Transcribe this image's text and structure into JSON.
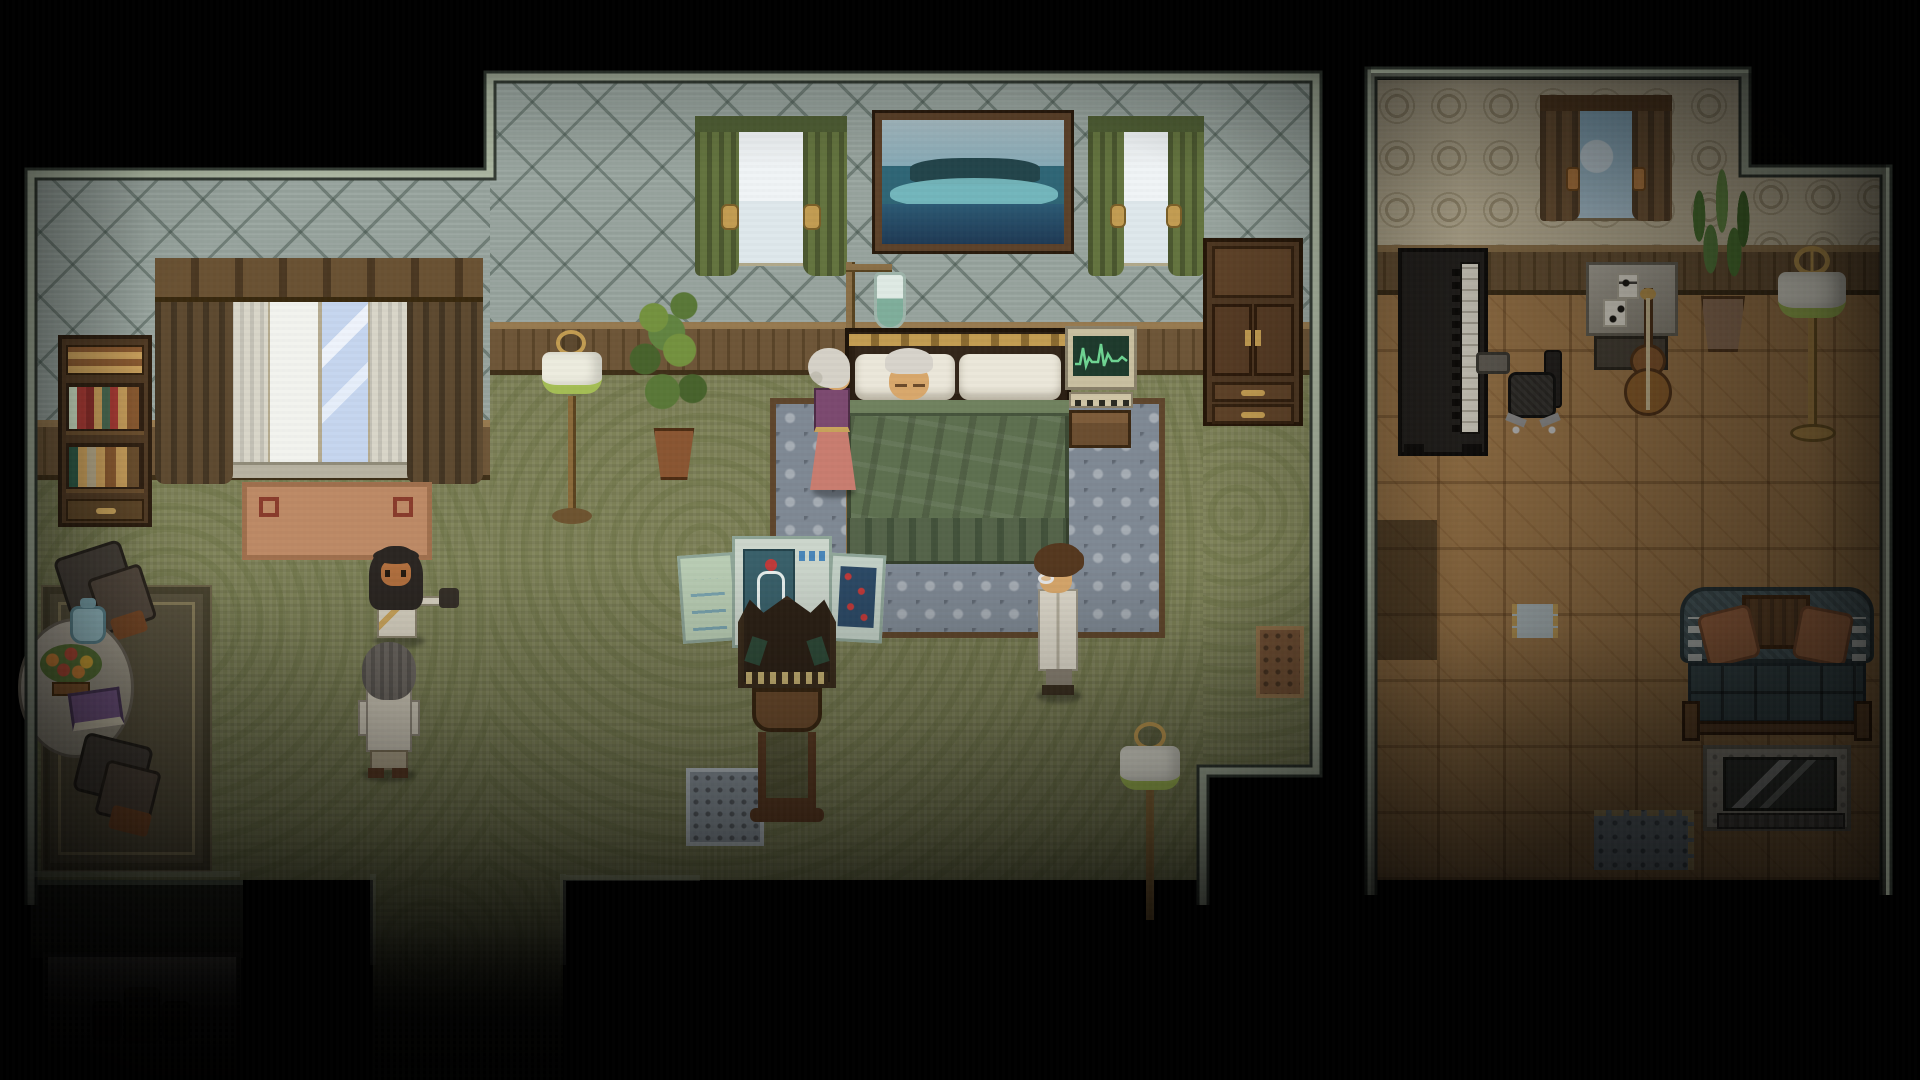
{
  "scene": {
    "viewport_label": "Pixel-art RPG interior — bedroom with patient and adjacent study",
    "visible_text": "",
    "rooms": {
      "bedroom": {
        "label": "Bedroom with sick bed, medical equipment and sitting corner"
      },
      "study": {
        "label": "Study and music room with piano, cello and couch"
      }
    }
  },
  "palette": {
    "bg": "#000000",
    "wall_border": "#aab5a0",
    "wall_border_dark": "#343c34",
    "wallpaper_main": "#95a19b",
    "wainscot": "#6e5638",
    "wainscot_light": "#977a50",
    "carpet": "#7d8157",
    "wood_floor": "#a8804f",
    "wallpaper_study": "#cdc2a4",
    "curtain_green": "#64743f",
    "drape_brown": "#5e4a30",
    "blanket_green": "#5e7050",
    "bed_rug": "#7f8994",
    "rug_border": "#5f462c",
    "monitor_screen": "#1e3a2c",
    "monitor_wave": "#6ed492",
    "lamp_shade": "#edecdf",
    "lamp_rim": "#a4bd55",
    "brass": "#c29c52",
    "skin": "#d9a86c",
    "coat_white": "#ddd8ca",
    "couch_teal": "#54686e",
    "pillow_orange": "#ad6f48",
    "mat_brown": "#7a5638",
    "teapot_blue": "#9cc4cc",
    "book_purple": "#7a5a8c"
  },
  "objects": {
    "bed": {
      "label": "Bed with elderly patient under green blanket"
    },
    "bed_rug": {
      "label": "Patterned blue-gray rug under bed"
    },
    "painting": {
      "label": "Framed seascape painting of an island"
    },
    "window_drapes": {
      "label": "Large window with brown drapes and sheers"
    },
    "window_green_left": {
      "label": "Window with green curtains (left of painting)"
    },
    "window_green_right": {
      "label": "Window with green curtains (right of painting)"
    },
    "bookshelf": {
      "label": "Dark wood bookshelf with colored books"
    },
    "tan_rug": {
      "label": "Tan rug below the drape window"
    },
    "wardrobe": {
      "label": "Tall wardrobe with doors and drawers"
    },
    "iv_stand": {
      "label": "Wooden IV drip stand with fluid bag"
    },
    "ekg_monitor": {
      "label": "EKG heart monitor on wooden stand"
    },
    "floor_lamp_left": {
      "label": "Floor lamp with white and green shade"
    },
    "floor_lamp_corner": {
      "label": "Floor lamp near south exit"
    },
    "plant_bedroom": {
      "label": "Bushy potted plant"
    },
    "trifold_screen": {
      "label": "Tri-fold medical chart screen with anatomy poster"
    },
    "ornate_chair": {
      "label": "Ornate high-backed chair at foot of bed"
    },
    "gray_mat": {
      "label": "Gray mat south of the chart screen"
    },
    "door_mat": {
      "label": "Brown doormat at east doorway"
    },
    "area_rug": {
      "label": "Dark sitting-corner area rug"
    },
    "round_table": {
      "label": "Round cloth-covered tea table"
    },
    "teapot": {
      "label": "Blue teapot"
    },
    "flower_basket": {
      "label": "Basket of orange and red flowers"
    },
    "purple_book": {
      "label": "Purple book on the table"
    },
    "armchair_upper": {
      "label": "Upholstered armchair (north of table)"
    },
    "armchair_lower": {
      "label": "Upholstered armchair (south of table)"
    },
    "shadow_table": {
      "label": "Dim table with luggage in dark alcove"
    },
    "corridor": {
      "label": "Carpeted corridor leading south"
    },
    "study_window": {
      "label": "Study window with brown curtains"
    },
    "piano": {
      "label": "Upright piano seen from above"
    },
    "office_chair": {
      "label": "Black swivel office chair"
    },
    "music_desk": {
      "label": "Desk with sheet music"
    },
    "cello": {
      "label": "Cello leaning by the desk"
    },
    "study_plant": {
      "label": "Tall potted palm plant"
    },
    "study_lamp": {
      "label": "Brass floor lamp"
    },
    "couch": {
      "label": "Checkered couch with orange pillows"
    },
    "tv_stand": {
      "label": "Television on low stand"
    },
    "study_rug": {
      "label": "Blue rug corner with fringe"
    },
    "study_mat": {
      "label": "Small light mat by study wall"
    }
  },
  "characters": {
    "sleeping_elder": {
      "label": "Elderly man asleep in bed"
    },
    "old_woman": {
      "label": "Elderly woman in purple dress at bedside"
    },
    "doctor": {
      "label": "Doctor with glasses in white coat"
    },
    "caretaker": {
      "label": "Woman with long dark hair holding a dark bag"
    },
    "visitor": {
      "label": "Gray-haired visitor seen from behind"
    }
  }
}
